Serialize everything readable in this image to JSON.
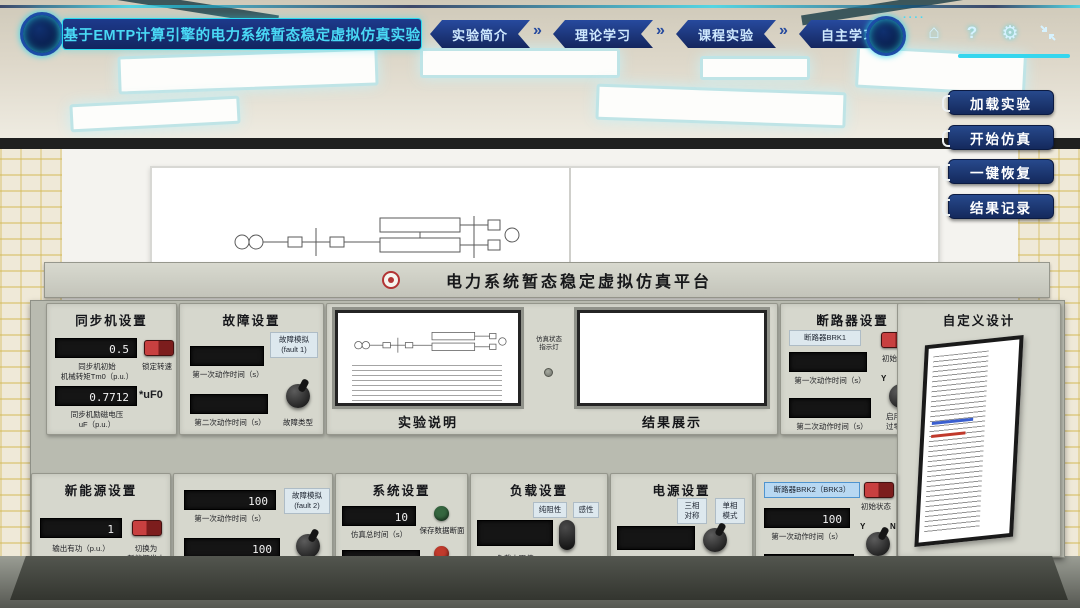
{
  "topbar": {
    "title": "基于EMTP计算引擎的电力系统暂态稳定虚拟仿真实验",
    "nav": [
      {
        "label": "实验简介"
      },
      {
        "label": "理论学习"
      },
      {
        "label": "课程实验"
      },
      {
        "label": "自主学习"
      }
    ],
    "icons": [
      {
        "name": "home-icon",
        "glyph": "⌂"
      },
      {
        "name": "help-icon",
        "glyph": "?"
      },
      {
        "name": "settings-icon",
        "glyph": "⚙"
      },
      {
        "name": "fullscreen-icon",
        "glyph": "⇲"
      }
    ]
  },
  "side_buttons": [
    {
      "label": "加载实验"
    },
    {
      "label": "开始仿真"
    },
    {
      "label": "一键恢复"
    },
    {
      "label": "结果记录"
    }
  ],
  "grade_button": {
    "label": "成绩查看"
  },
  "console": {
    "title": "电力系统暂态稳定虚拟仿真平台",
    "sync": {
      "title": "同步机设置",
      "d1": {
        "value": "0.5",
        "label": "同步机初始\n机械转矩Tm0（p.u.）"
      },
      "switch_label": "锁定转速",
      "d2": {
        "value": "0.7712",
        "side_label": "*uF0",
        "label": "同步机励磁电压\nuF（p.u.）"
      }
    },
    "fault1": {
      "title": "故障设置",
      "tag": "故障模拟\n(fault 1)",
      "d1": {
        "value": "",
        "label": "第一次动作时间（s）"
      },
      "d2": {
        "value": "",
        "label": "第二次动作时间（s）"
      },
      "knob_label": "故障类型"
    },
    "screens": {
      "experiment_label": "实验说明",
      "result_label": "结果展示",
      "indicator_label": "仿真状态\n指示灯"
    },
    "breaker1": {
      "title": "断路器设置",
      "tag": "断路器BRK1",
      "switch_label": "初始状态",
      "d1": {
        "value": "",
        "label": "第一次动作时间（s）"
      },
      "knob": {
        "y": "Y",
        "n": "N",
        "label": "启用电流\n过零开断"
      },
      "d2": {
        "value": "",
        "label": "第二次动作时间（s）"
      }
    },
    "custom": {
      "title": "自定义设计"
    },
    "new_energy": {
      "title": "新能源设置",
      "d1": {
        "value": "1",
        "label": "输出有功（p.u.）"
      },
      "switch_label": "切换为\n新能源发电"
    },
    "fault2": {
      "tag": "故障模拟\n(fault 2)",
      "d1": {
        "value": "100",
        "label": "第一次动作时间（s）"
      },
      "d2": {
        "value": "100",
        "label": "第二次动作时间（s）"
      },
      "knob_label": "故障类型"
    },
    "system": {
      "title": "系统设置",
      "d1": {
        "value": "10",
        "label": "仿真总时间（s）"
      },
      "green_button_label": "保存数据断面",
      "d2": {
        "value": "50",
        "label": "仿真步长（μs）"
      },
      "red_button_label": "启用数据\n断面初始化"
    },
    "load": {
      "title": "负载设置",
      "d1": {
        "value": "",
        "label": "负载电阻值\n(Ohm)"
      },
      "toggle": {
        "opt1": "纯阻性",
        "opt2": "感性",
        "label": "负载类型选择"
      }
    },
    "power": {
      "title": "电源设置",
      "d1": {
        "value": "",
        "label": "电源线电压有效值\nVg(kV,p-p,rms)"
      },
      "toggle": {
        "opt1": "三相\n对称",
        "opt2": "单相\n模式",
        "label": "三相电源\n相位状态选择"
      }
    },
    "breaker2": {
      "tag": "断路器BRK2（BRK3）",
      "switch_label": "初始状态",
      "d1": {
        "value": "100",
        "label": "第一次动作时间（s）"
      },
      "knob": {
        "y": "Y",
        "n": "N",
        "label": "启用电流\n过零开断"
      },
      "d2": {
        "value": "100",
        "label": "第二次动作时间（s）"
      }
    }
  },
  "colors": {
    "accent_cyan": "#3fdcf2",
    "navbar_navy": "#162f7a",
    "button_navy": "#1c3a74",
    "console_gray": "#d6d7cd",
    "display_black": "#151515",
    "switch_red": "#b83230",
    "save_button_green": "#35663f",
    "init_button_red": "#c13a2c"
  }
}
